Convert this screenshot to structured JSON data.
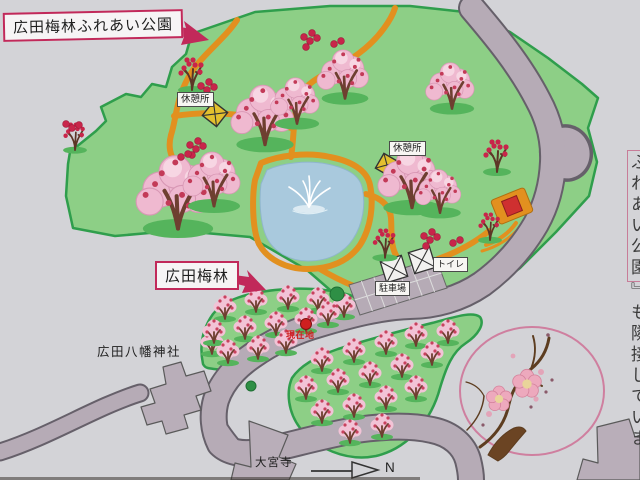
{
  "sign": {
    "title": "広田梅林ふれあい公園",
    "plum_grove_label": "広田梅林",
    "rest_area_label": "休憩所",
    "toilet_label": "トイレ",
    "parking_label": "駐車場",
    "current_location_label": "現在地",
    "shrine_label": "広田八幡神社",
    "temple_label": "大宮寺",
    "north_label": "N",
    "side_note_boxed": "ふれあい公園",
    "side_note_rest": "』も隣接していま"
  },
  "colors": {
    "background": "#d3d3d7",
    "park_green": "#8dcf86",
    "park_border": "#2f9e4c",
    "trail_orange": "#e2901f",
    "pond_blue": "#a9c9dd",
    "road_gray": "#b6abb6",
    "road_outline": "#66606a",
    "building_gray": "#b9aeb9",
    "canopy_pink": "#efb9d0",
    "canopy_light": "#f7d6e3",
    "grove_pink": "#f2c3d6",
    "blossom_red": "#c33a58",
    "cluster_red": "#c8254a",
    "trunk_brown": "#6e3f30",
    "shadow_green": "#55b45c",
    "hut_yellow": "#e3c02e",
    "accent_crimson": "#c1295a",
    "current_red": "#cf1f1f",
    "emblem_pink": "#cf7f9f"
  },
  "map": {
    "trees_large": [
      {
        "x": 178,
        "y": 207,
        "s": 1.35
      },
      {
        "x": 214,
        "y": 190,
        "s": 1.0
      },
      {
        "x": 265,
        "y": 127,
        "s": 1.1
      },
      {
        "x": 297,
        "y": 110,
        "s": 0.85
      },
      {
        "x": 345,
        "y": 84,
        "s": 0.9
      },
      {
        "x": 452,
        "y": 95,
        "s": 0.85
      },
      {
        "x": 412,
        "y": 190,
        "s": 1.1
      },
      {
        "x": 440,
        "y": 200,
        "s": 0.8
      }
    ],
    "trees_red": [
      {
        "x": 192,
        "y": 78,
        "s": 1.0
      },
      {
        "x": 75,
        "y": 140,
        "s": 0.85
      },
      {
        "x": 497,
        "y": 160,
        "s": 1.0
      },
      {
        "x": 385,
        "y": 247,
        "s": 0.9
      },
      {
        "x": 490,
        "y": 230,
        "s": 0.85
      }
    ],
    "trees_grove": [
      {
        "x": 212,
        "y": 345
      },
      {
        "x": 225,
        "y": 310
      },
      {
        "x": 256,
        "y": 303
      },
      {
        "x": 288,
        "y": 300
      },
      {
        "x": 318,
        "y": 302
      },
      {
        "x": 344,
        "y": 308
      },
      {
        "x": 214,
        "y": 334
      },
      {
        "x": 245,
        "y": 330
      },
      {
        "x": 276,
        "y": 326
      },
      {
        "x": 306,
        "y": 322
      },
      {
        "x": 328,
        "y": 316
      },
      {
        "x": 228,
        "y": 354
      },
      {
        "x": 258,
        "y": 350
      },
      {
        "x": 286,
        "y": 344
      },
      {
        "x": 322,
        "y": 362
      },
      {
        "x": 354,
        "y": 353
      },
      {
        "x": 386,
        "y": 345
      },
      {
        "x": 416,
        "y": 337
      },
      {
        "x": 448,
        "y": 334
      },
      {
        "x": 306,
        "y": 390
      },
      {
        "x": 338,
        "y": 383
      },
      {
        "x": 370,
        "y": 376
      },
      {
        "x": 402,
        "y": 368
      },
      {
        "x": 432,
        "y": 356
      },
      {
        "x": 322,
        "y": 414
      },
      {
        "x": 354,
        "y": 408
      },
      {
        "x": 386,
        "y": 400
      },
      {
        "x": 416,
        "y": 390
      },
      {
        "x": 350,
        "y": 434
      },
      {
        "x": 382,
        "y": 428
      }
    ],
    "flower_clusters": [
      {
        "x": 207,
        "y": 90,
        "n": 4
      },
      {
        "x": 310,
        "y": 41,
        "n": 5
      },
      {
        "x": 334,
        "y": 44,
        "n": 2
      },
      {
        "x": 196,
        "y": 149,
        "n": 5
      },
      {
        "x": 181,
        "y": 157,
        "n": 2
      },
      {
        "x": 430,
        "y": 240,
        "n": 5
      },
      {
        "x": 453,
        "y": 243,
        "n": 2
      },
      {
        "x": 72,
        "y": 128,
        "n": 3
      }
    ]
  }
}
